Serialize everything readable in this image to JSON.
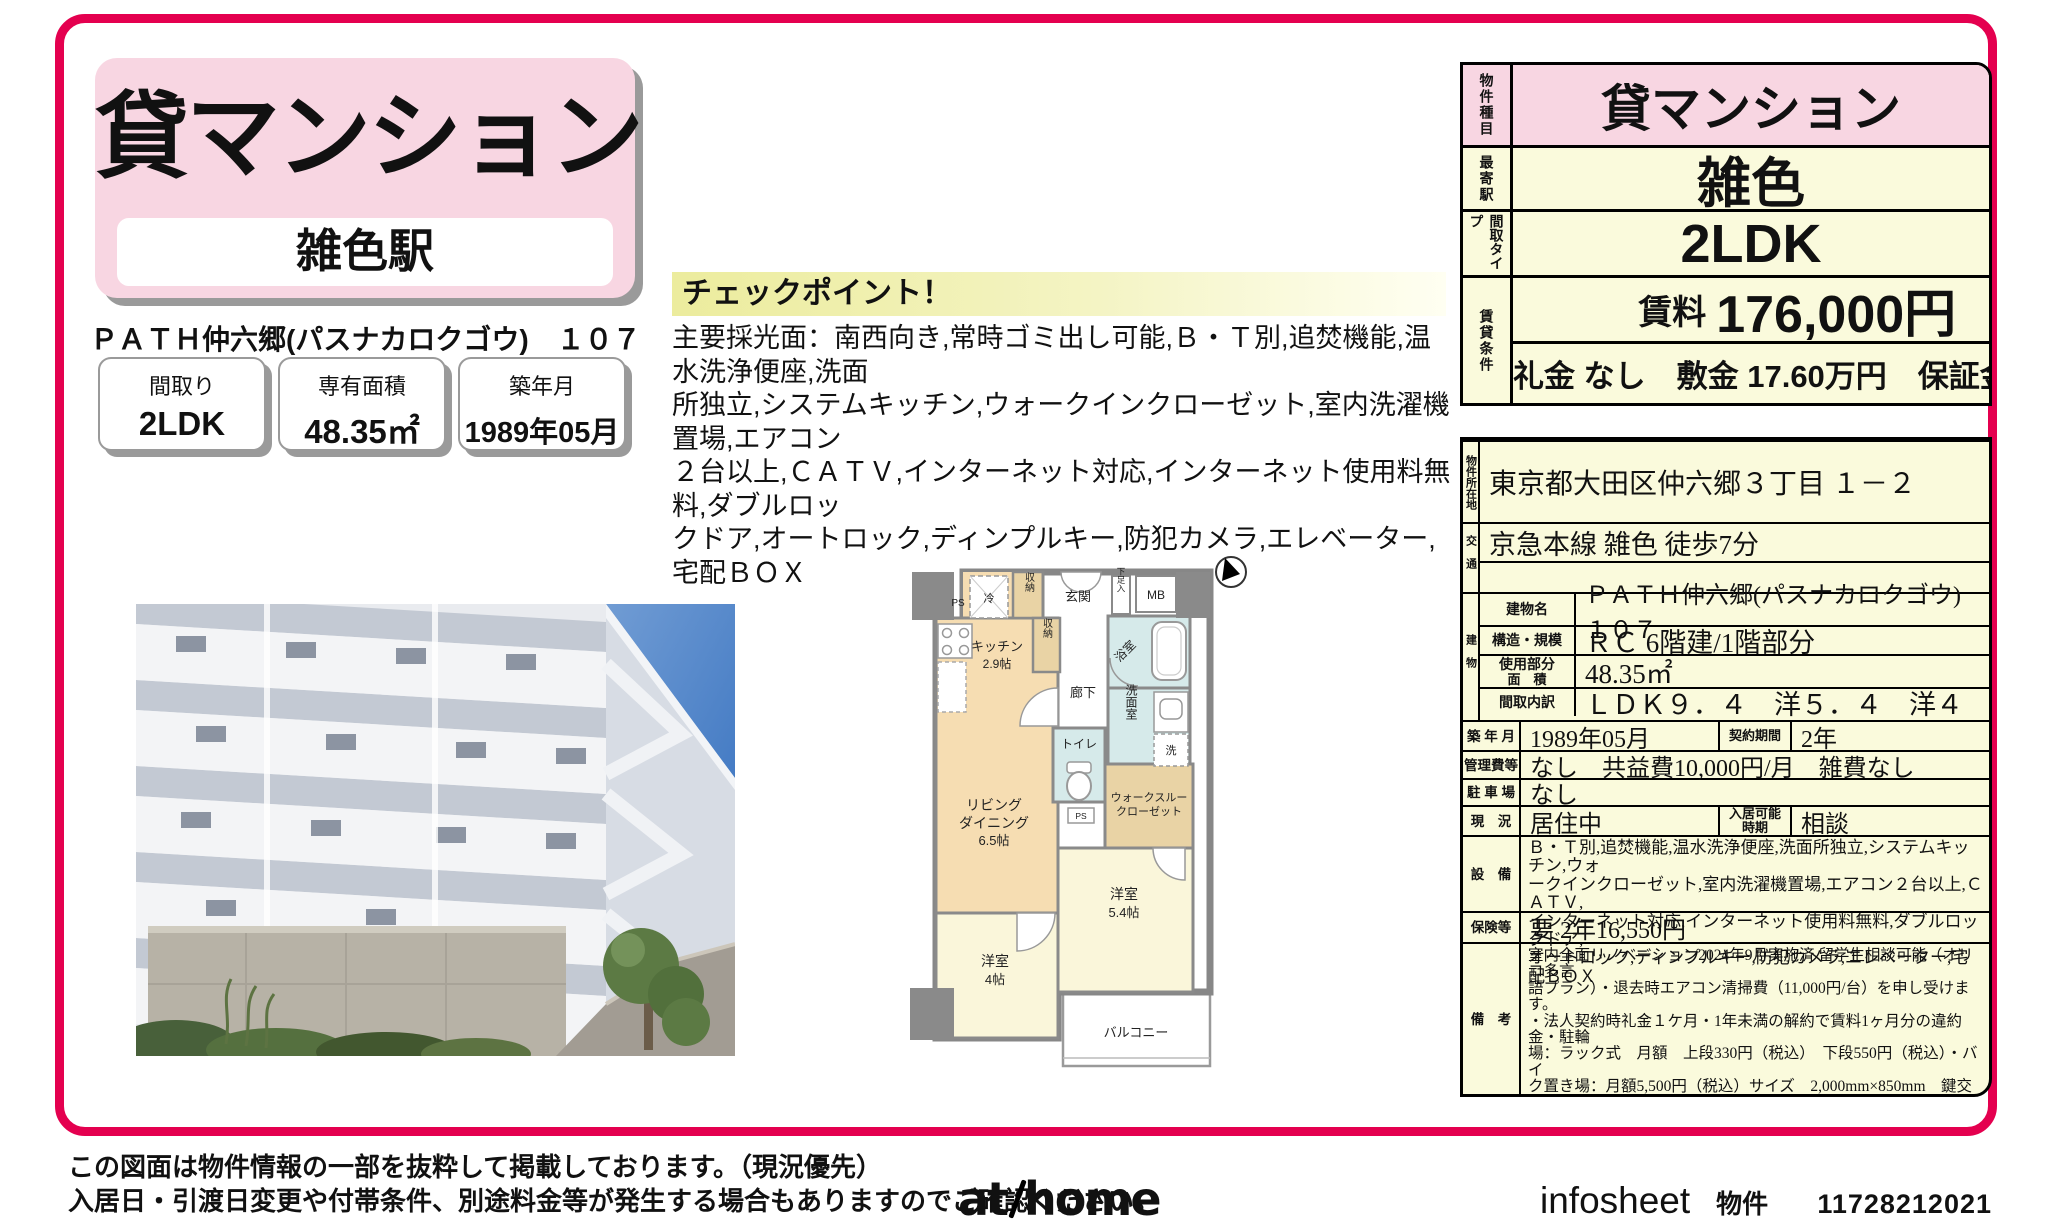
{
  "colors": {
    "frame_pink": "#e4004f",
    "card_pink": "#f8d6e2",
    "table_cream": "#fafadc",
    "checkpoint_yellow": "#ecec9d"
  },
  "header": {
    "category": "貸マンション",
    "station": "雑色駅",
    "property_line": "ＰＡＴＨ仲六郷(パスナカロクゴウ)　１０７",
    "summary_boxes": [
      {
        "label": "間取り",
        "value": "2LDK"
      },
      {
        "label": "専有面積",
        "value": "48.35㎡"
      },
      {
        "label": "築年月",
        "value": "1989年05月"
      }
    ]
  },
  "checkpoint": {
    "title": "チェックポイント！",
    "body": "主要採光面：南西向き,常時ゴミ出し可能,Ｂ・Ｔ別,追焚機能,温水洗浄便座,洗面\n所独立,システムキッチン,ウォークインクローゼット,室内洗濯機置場,エアコン\n２台以上,ＣＡＴＶ,インターネット対応,インターネット使用料無料,ダブルロッ\nクドア,オートロック,ディンプルキー,防犯カメラ,エレベーター,宅配ＢＯＸ"
  },
  "spec_table": {
    "rows": [
      {
        "label": "物件種目",
        "value": "貸マンション"
      },
      {
        "label": "最寄駅",
        "value": "雑色"
      },
      {
        "label": "間取タイプ",
        "value": "2LDK"
      },
      {
        "label": "賃貸条件",
        "rent_label": "賃料",
        "rent": "176,000円",
        "terms": "礼金 なし　敷金 17.60万円　保証金 なし"
      }
    ]
  },
  "detail_table": {
    "address_label": "物件所在地",
    "address": "東京都大田区仲六郷３丁目 １－２",
    "access_label": "交通",
    "access1": "京急本線 雑色 徒歩7分",
    "access2": "",
    "building_label": "建物",
    "building_rows": [
      {
        "label": "建物名",
        "value": "ＰＡＴＨ仲六郷(パスナカロクゴウ)　１０７"
      },
      {
        "label": "構造・規模",
        "value": "ＲＣ 6階建/1階部分"
      },
      {
        "label_line1": "使用部分",
        "label_line2": "面　積",
        "value": "48.35㎡"
      },
      {
        "label": "間取内訳",
        "value": "ＬＤＫ９．４　洋５．４　洋４"
      }
    ],
    "built_label": "築 年 月",
    "built": "1989年05月",
    "contract_label": "契約期間",
    "contract": "2年",
    "mgmt_label": "管理費等",
    "mgmt": "なし　共益費10,000円/月　雑費なし",
    "parking_label": "駐 車 場",
    "parking": "なし",
    "status_label": "現　況",
    "status": "居住中",
    "movein_label_1": "入居可能",
    "movein_label_2": "時期",
    "movein": "相談",
    "equip_label": "設　備",
    "equipment": "Ｂ・Ｔ別,追焚機能,温水洗浄便座,洗面所独立,システムキッチン,ウォ\nークインクローゼット,室内洗濯機置場,エアコン２台以上,ＣＡＴＶ,\nインターネット対応,インターネット使用料無料,ダブルロックドア,\nオートロック,ディンプルキー,防犯カメラ,エレベーター,宅配ＢＯＸ",
    "insurance_label": "保険等",
    "insurance": "要 2年16,550円",
    "notes_label": "備　考",
    "notes": "室内全面リノベーション2024年9月実施済 留学生相談可能（オリコ多言\n語プラン）・退去時エアコン清掃費（11,000円/台）を申し受けます。\n・法人契約時礼金１ケ月・1年未満の解約で賃料1ヶ月分の違約金・駐輪\n場：ラック式　月額　上段330円（税込）　下段550円（税込）・バイ\nク置き場：月額5,500円（税込）サイズ　2,000mm×850mm　鍵交換\n代：33,000円　清掃費：51,920円　エアコン清掃費：22,000円　更新\n料：新賃料１ヶ月　賃貸保証：加入要 エポスカード（ＲＰ）　保証料：\n賃料等の50％(最低2万)、月額保証料：賃料等の1％(更新料無)　利用駅\n１：ＪＲ京浜東北・根岸線 蒲田 徒歩19分"
  },
  "floorplan": {
    "labels": {
      "ps_top": "PS",
      "fridge": "冷",
      "closet_top": "収納",
      "entrance": "玄関",
      "shoe_box": "下足入",
      "mb": "MB",
      "kitchen": "キッチン",
      "kitchen_size": "2.9帖",
      "closet_mid": "収納",
      "hallway": "廊下",
      "bath": "浴室",
      "washroom": "洗面室",
      "washer": "洗",
      "toilet": "トイレ",
      "living_1": "リビング",
      "living_2": "ダイニング",
      "living_size": "6.5帖",
      "wtc_1": "ウォークスルー",
      "wtc_2": "クローゼット",
      "room_a": "洋室",
      "room_a_size": "5.4帖",
      "room_b": "洋室",
      "room_b_size": "4帖",
      "balcony": "バルコニー",
      "ps_bottom": "PS"
    }
  },
  "footer": {
    "disclaimer_1": "この図面は物件情報の一部を抜粋して掲載しております。（現況優先）",
    "disclaimer_2": "入居日・引渡日変更や付帯条件、別途料金等が発生する場合もありますのでご確認ください。",
    "logo_at": "at",
    "logo_home": "home",
    "infosheet_label": "infosheet",
    "property_no_label": "物件番号",
    "property_no": "11728212021"
  }
}
